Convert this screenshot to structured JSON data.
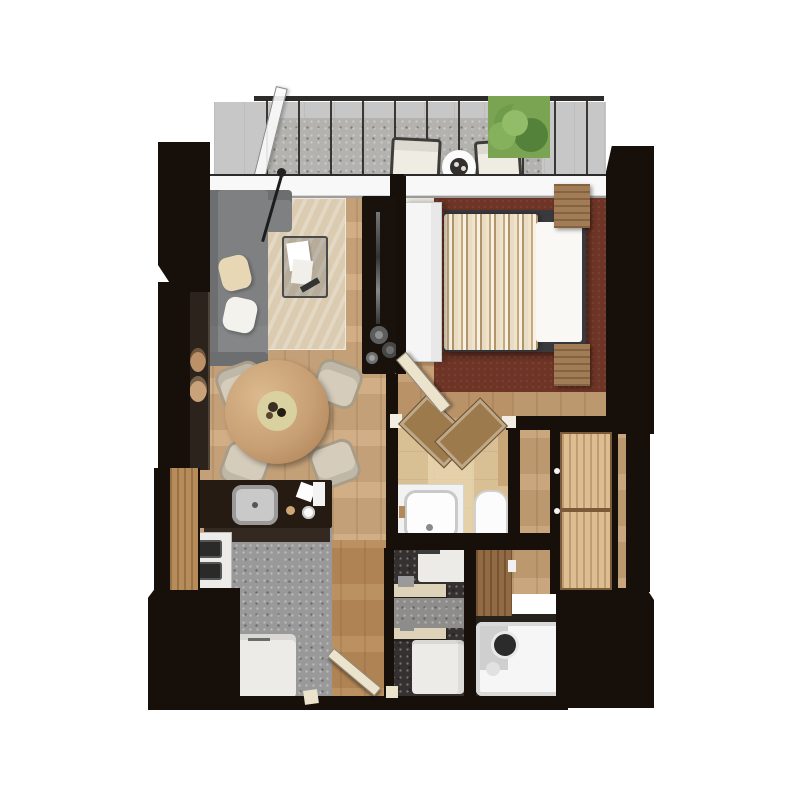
{
  "meta": {
    "title": "apartment-3d-floor-plan",
    "view": "top-down isometric render, no text labels"
  },
  "colors": {
    "background": "#ffffff",
    "wall": "#170f0a",
    "wallInner": "#241a12",
    "woodLiving": "#cfa97e",
    "woodBedroom": "#c39a6e",
    "woodEntry": "#b88a58",
    "woodCorridor": "#c6a075",
    "rugLiving": "#dacbb1",
    "rugBedroom": "#6e3526",
    "balconyFloor": "#c7c7c7",
    "balconyMat": "#b3b2ae",
    "kitchenFloor": "#999999",
    "laundryFloor": "#353130",
    "laundryMat": "#8e8d8b",
    "bathFloorDark": "#27211c",
    "tileBeige": "#d9bf94",
    "tileLight": "#e6d4ae",
    "counterDark": "#251b13",
    "counterKick": "#342920",
    "cabinetWood": "#b28550",
    "bathCabinetWood": "#8a6239",
    "closetWood": "#dcba8a",
    "sofaGray": "#7e8082",
    "sofaDark": "#6c6e70",
    "pillowBeige": "#e7d7b4",
    "pillowWhite": "#f4f2ec",
    "tableMarble": "#c79f74",
    "plateOlive": "#d9d2a0",
    "chairBeige": "#d5ccbb",
    "chairEdge": "#a99d87",
    "duvetBase": "#ead9bd",
    "mattress": "#faf8f4",
    "bedFrame": "#3a393d",
    "nightstand": "#9b744b",
    "applianceWhite": "#edebe8",
    "tubWhite": "#f6f6f6",
    "plantGreen": "#7aa352",
    "doorBrown": "#9c7a4c",
    "doorCream": "#ece3cd",
    "consoleDark": "#2b231c",
    "tvConsole": "#18110c",
    "windowSill": "#f8f8f8",
    "rail": "#2e2c2a",
    "sinkSteel": "#c9c9c9"
  },
  "rooms": [
    {
      "id": "balcony",
      "furniture": [
        "glass-wind-screen",
        "lounge-chair",
        "lounge-chair",
        "round-side-table",
        "potted-plant",
        "railing"
      ]
    },
    {
      "id": "living-dining",
      "furniture": [
        "l-shaped-sofa",
        "two-pillows",
        "area-rug",
        "arc-floor-lamp",
        "glass-coffee-table",
        "console-with-vases",
        "round-marble-dining-table",
        "four-dining-chairs"
      ]
    },
    {
      "id": "kitchen",
      "furniture": [
        "counter-with-sink",
        "gas-stove",
        "tall-cabinet",
        "refrigerator"
      ]
    },
    {
      "id": "bedroom",
      "furniture": [
        "double-bed-striped-duvet",
        "two-nightstands",
        "area-rug",
        "tv-console-with-vases",
        "white-sliding-panel",
        "swing-door"
      ]
    },
    {
      "id": "bathroom",
      "furniture": [
        "vanity-sink",
        "toilet",
        "double-brown-doors"
      ]
    },
    {
      "id": "laundry",
      "furniture": [
        "washing-machine",
        "washing-machine",
        "two-step-shelves",
        "floor-mat"
      ]
    },
    {
      "id": "bath",
      "furniture": [
        "bathtub",
        "wood-cabinet"
      ]
    },
    {
      "id": "closet",
      "furniture": [
        "hanger-rail-upper",
        "hanger-rail-lower"
      ]
    },
    {
      "id": "entrance",
      "furniture": [
        "entry-door",
        "thresholds"
      ]
    }
  ]
}
